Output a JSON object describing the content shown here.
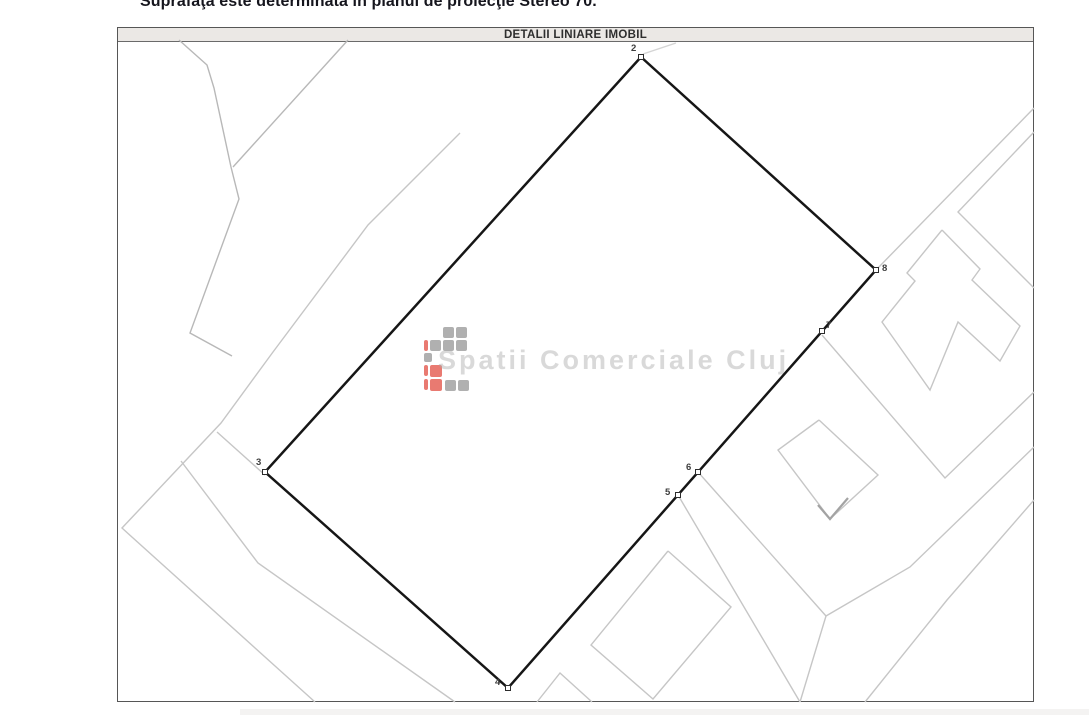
{
  "header": {
    "surface_note": "Suprafaţa este determinată în planul de proiecţie Stereo 70.",
    "plan_title": "DETALII LINIARE IMOBIL"
  },
  "watermark": {
    "text": "Spatii Comerciale Cluj"
  },
  "plan": {
    "boundary": {
      "color": "#161616",
      "width": 2.5,
      "points": [
        [
          641,
          57
        ],
        [
          876,
          270
        ],
        [
          508,
          688
        ],
        [
          265,
          472
        ]
      ]
    },
    "parcel_line_color": "#c6c6c6",
    "parcel_lines": [
      {
        "name": "parcel-line-topleft-jagged",
        "stroke": "#b8b8b8",
        "points": [
          [
            179,
            40
          ],
          [
            207,
            65
          ],
          [
            214,
            88
          ],
          [
            231,
            167
          ],
          [
            239,
            199
          ],
          [
            190,
            333
          ],
          [
            232,
            356
          ]
        ]
      },
      {
        "name": "parcel-line-topleft-triangle",
        "stroke": "#b8b8b8",
        "points": [
          [
            348,
            40
          ],
          [
            233,
            167
          ]
        ]
      },
      {
        "name": "road-edge-left-long",
        "points": [
          [
            460,
            133
          ],
          [
            368,
            225
          ],
          [
            273,
            352
          ],
          [
            221,
            423
          ],
          [
            122,
            528
          ],
          [
            315,
            702
          ]
        ]
      },
      {
        "name": "road-edge-left-parallel",
        "points": [
          [
            181,
            461
          ],
          [
            258,
            563
          ],
          [
            455,
            702
          ]
        ]
      },
      {
        "name": "parcel-line-to-vertex3",
        "points": [
          [
            217,
            432
          ],
          [
            265,
            475
          ]
        ]
      },
      {
        "name": "tick-through-vertex2",
        "stroke": "#d4d4d4",
        "points": [
          [
            643,
            54
          ],
          [
            676,
            43
          ]
        ]
      },
      {
        "name": "road-edge-right-upper",
        "points": [
          [
            1034,
            108
          ],
          [
            876,
            270
          ]
        ]
      },
      {
        "name": "road-edge-right-parallel",
        "points": [
          [
            1034,
            132
          ],
          [
            958,
            212
          ],
          [
            1034,
            288
          ]
        ]
      },
      {
        "name": "building-right-t-shape",
        "points": [
          [
            942,
            230
          ],
          [
            980,
            269
          ],
          [
            972,
            280
          ],
          [
            1020,
            326
          ],
          [
            1000,
            361
          ],
          [
            958,
            322
          ],
          [
            930,
            390
          ],
          [
            882,
            322
          ],
          [
            915,
            281
          ],
          [
            907,
            273
          ],
          [
            942,
            230
          ]
        ]
      },
      {
        "name": "parcel-corner-from-vertex7",
        "points": [
          [
            822,
            335
          ],
          [
            945,
            478
          ],
          [
            1034,
            392
          ]
        ]
      },
      {
        "name": "building-diamond-mid",
        "points": [
          [
            819,
            420
          ],
          [
            878,
            475
          ],
          [
            830,
            519
          ],
          [
            778,
            450
          ],
          [
            819,
            420
          ]
        ]
      },
      {
        "name": "building-corner-mark",
        "stroke": "#a3a3a3",
        "width": 2.2,
        "points": [
          [
            818,
            505
          ],
          [
            830,
            519
          ],
          [
            848,
            498
          ]
        ]
      },
      {
        "name": "road-from-vertex6",
        "points": [
          [
            698,
            472
          ],
          [
            826,
            616
          ]
        ]
      },
      {
        "name": "road-edge-bottomright-1",
        "points": [
          [
            1034,
            447
          ],
          [
            910,
            567
          ],
          [
            826,
            616
          ],
          [
            800,
            702
          ]
        ]
      },
      {
        "name": "road-from-vertex5",
        "points": [
          [
            678,
            495
          ],
          [
            800,
            702
          ]
        ]
      },
      {
        "name": "road-edge-bottomright-2",
        "points": [
          [
            1034,
            500
          ],
          [
            947,
            600
          ],
          [
            865,
            702
          ]
        ]
      },
      {
        "name": "building-diamond-bottom",
        "points": [
          [
            668,
            551
          ],
          [
            731,
            607
          ],
          [
            653,
            699
          ],
          [
            591,
            645
          ],
          [
            668,
            551
          ]
        ]
      },
      {
        "name": "triangle-bottom",
        "points": [
          [
            537,
            702
          ],
          [
            560,
            673
          ],
          [
            592,
            702
          ]
        ]
      }
    ],
    "vertices": [
      {
        "label": "2",
        "x": 641,
        "y": 57,
        "dx": -10,
        "dy": -6
      },
      {
        "label": "8",
        "x": 876,
        "y": 270,
        "dx": 6,
        "dy": 1
      },
      {
        "label": "7",
        "x": 822,
        "y": 331,
        "dx": 4,
        "dy": -3
      },
      {
        "label": "6",
        "x": 698,
        "y": 472,
        "dx": -12,
        "dy": -2
      },
      {
        "label": "5",
        "x": 678,
        "y": 495,
        "dx": -13,
        "dy": 0
      },
      {
        "label": "4",
        "x": 508,
        "y": 688,
        "dx": -13,
        "dy": -3
      },
      {
        "label": "3",
        "x": 265,
        "y": 472,
        "dx": -9,
        "dy": -7
      }
    ],
    "marker": {
      "size": 5,
      "fill": "#ffffff",
      "stroke": "#2c2c2c"
    },
    "logo": {
      "gray": "#9c9c9c",
      "red": "#e4594e",
      "opacity": 0.8,
      "cells": [
        {
          "x": 443,
          "y": 327,
          "w": 11,
          "h": 11,
          "c": "gray"
        },
        {
          "x": 456,
          "y": 327,
          "w": 11,
          "h": 11,
          "c": "gray"
        },
        {
          "x": 424,
          "y": 340,
          "w": 4,
          "h": 11,
          "c": "red"
        },
        {
          "x": 430,
          "y": 340,
          "w": 11,
          "h": 11,
          "c": "gray"
        },
        {
          "x": 443,
          "y": 340,
          "w": 11,
          "h": 11,
          "c": "gray"
        },
        {
          "x": 456,
          "y": 340,
          "w": 11,
          "h": 11,
          "c": "gray"
        },
        {
          "x": 424,
          "y": 353,
          "w": 8,
          "h": 9,
          "c": "gray"
        },
        {
          "x": 424,
          "y": 365,
          "w": 4,
          "h": 11,
          "c": "red"
        },
        {
          "x": 430,
          "y": 365,
          "w": 12,
          "h": 12,
          "c": "red"
        },
        {
          "x": 424,
          "y": 379,
          "w": 4,
          "h": 11,
          "c": "red"
        },
        {
          "x": 430,
          "y": 379,
          "w": 12,
          "h": 12,
          "c": "red"
        },
        {
          "x": 445,
          "y": 380,
          "w": 11,
          "h": 11,
          "c": "gray"
        },
        {
          "x": 458,
          "y": 380,
          "w": 11,
          "h": 11,
          "c": "gray"
        }
      ]
    },
    "watermark_style": {
      "x": 438,
      "y": 369,
      "size": 27,
      "color": "#ababab",
      "opacity": 0.45
    },
    "artifact_band": {
      "x": 240,
      "y": 709,
      "w": 849,
      "h": 6,
      "fill": "#ebe9e7",
      "opacity": 0.55
    }
  }
}
